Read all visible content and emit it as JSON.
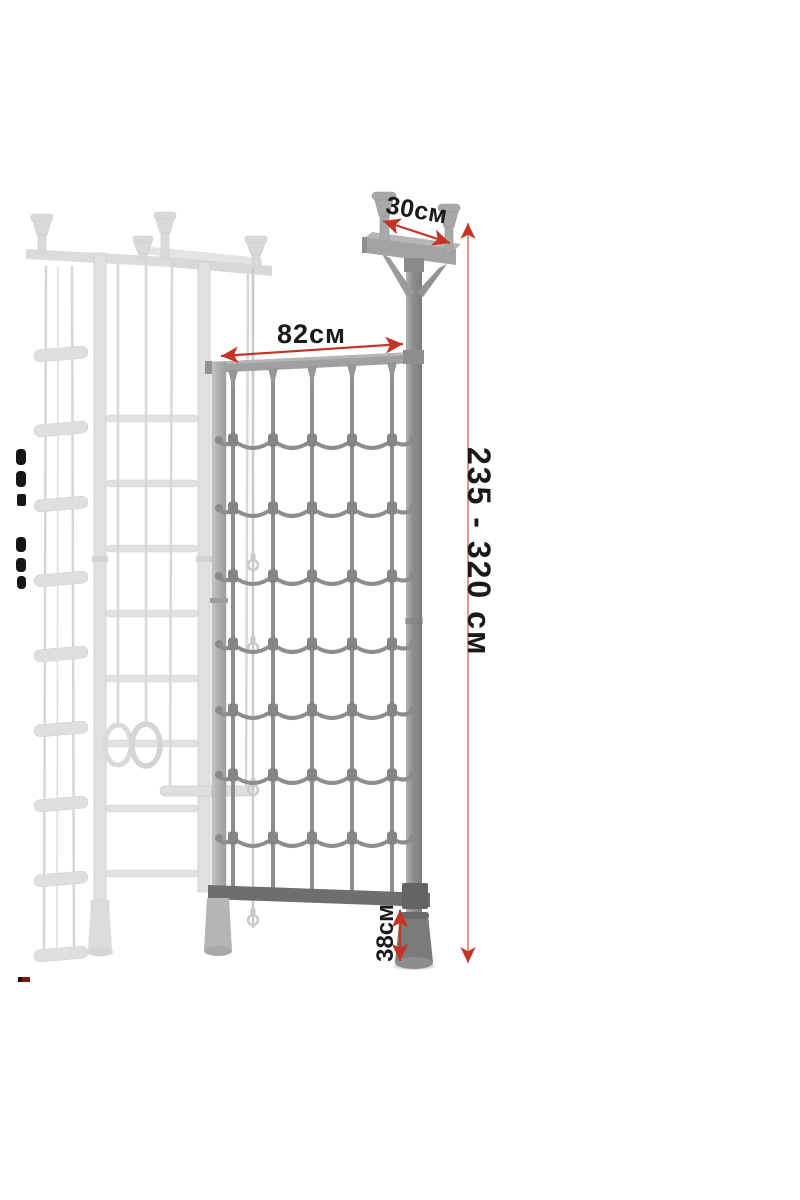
{
  "page": {
    "background": "#ffffff",
    "kind": "product dimension diagram"
  },
  "diagram": {
    "subject": "wall bars with climbing net",
    "annotations": {
      "top_bar_width": "30см",
      "net_width": "82см",
      "overall_height": "235 - 320 см",
      "floor_clearance": "38см"
    },
    "colors": {
      "arrow_red": "#c63325",
      "arrow_line_light": "#df968e",
      "label_text": "#1a1a1a",
      "net_rope_gray": "#8d8d8d",
      "frame_gray": "#9c9c9c",
      "dark_bottom_bar": "#6e6e6e",
      "faded_structure_gray": "#dcdcdc",
      "background": "#ffffff"
    }
  }
}
